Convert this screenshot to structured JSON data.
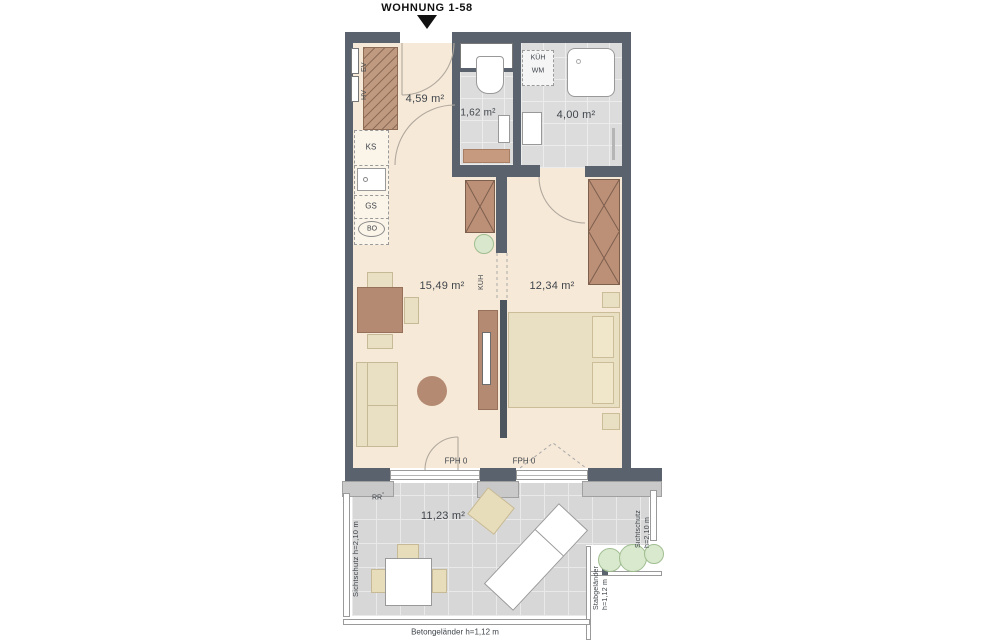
{
  "header": {
    "title": "WOHNUNG 1-58"
  },
  "rooms": {
    "hall": {
      "area": "4,59 m²"
    },
    "wc": {
      "area": "1,62 m²"
    },
    "bath": {
      "area": "4,00 m²"
    },
    "living": {
      "area": "15,49 m²"
    },
    "bedroom": {
      "area": "12,34 m²"
    },
    "terrace": {
      "area": "11,23 m²"
    }
  },
  "appliances": {
    "ev": "EV",
    "hv": "HV",
    "ks": "KS",
    "gs": "GS",
    "bo": "BO",
    "kueh": "KÜH",
    "wm": "WM",
    "kueh_passage": "KÜH"
  },
  "annotations": {
    "fph_left": "FPH 0",
    "fph_right": "FPH 0",
    "rr": "RR",
    "sichtschutz_left": "Sichtschutz h=2,10 m",
    "sichtschutz_right_1": "Sichtschutz",
    "sichtschutz_right_2": "h=2,10 m",
    "stab_1": "Stabgeländer",
    "stab_2": "h=1,12 m",
    "beton": "Betongeländer h=1,12 m"
  },
  "colors": {
    "wall": "#5a636d",
    "floor": "#f7e9d8",
    "tile": "#d9d9d9",
    "furniture_brown": "#b48b72",
    "furniture_cream": "#e9dfc2",
    "plant_green": "#cfe3c2"
  }
}
